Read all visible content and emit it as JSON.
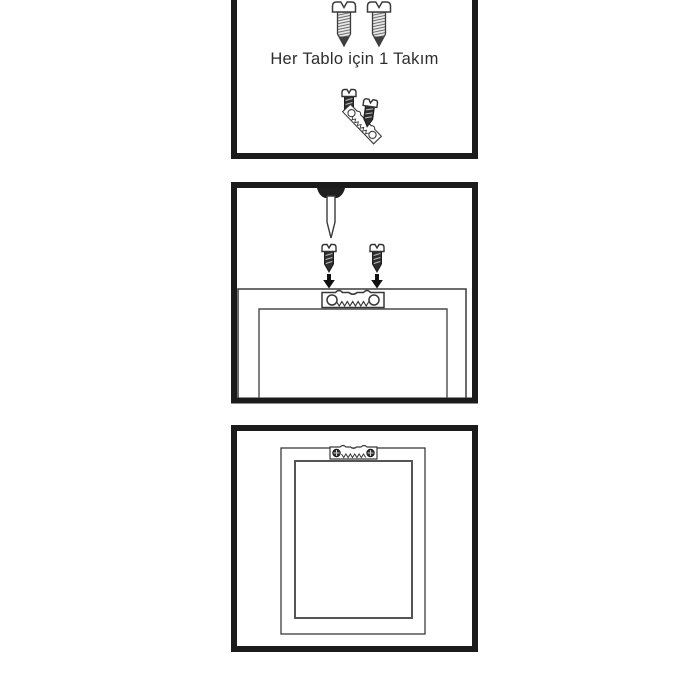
{
  "page": {
    "background": "#ffffff",
    "description_parts": [
      "kit-contents-panel",
      "installation-panel",
      "installed-result-panel"
    ]
  },
  "colors": {
    "panel_border": "#1b1b1b",
    "line": "#3c3c3c",
    "dark_metal": "#2e2e2e",
    "arrow": "#111111",
    "text": "#2d2d2d"
  },
  "panels": [
    {
      "name": "kit-contents",
      "caption": "Her Tablo için 1 Takım",
      "parts": [
        "large-screw",
        "large-screw",
        "small-screw",
        "sawtooth-hanger",
        "small-screw"
      ]
    },
    {
      "name": "installation",
      "parts": [
        "bradawl",
        "small-screw",
        "small-screw",
        "down-arrow",
        "down-arrow",
        "frame-back-top",
        "sawtooth-hanger"
      ]
    },
    {
      "name": "installed-result",
      "parts": [
        "frame-back",
        "sawtooth-hanger-installed"
      ]
    }
  ]
}
